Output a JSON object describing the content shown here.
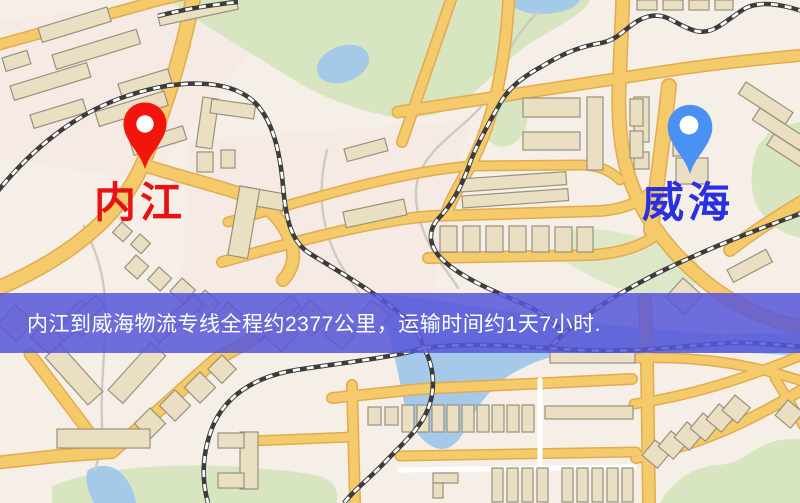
{
  "map": {
    "origin": {
      "label": "内江",
      "label_color": "#e81210",
      "pin_color": "#f2150b"
    },
    "destination": {
      "label": "威海",
      "label_color": "#2a2fdf",
      "pin_color": "#4b91f2"
    },
    "banner": {
      "text": "内江到威海物流专线全程约2377公里，运输时间约1天7小时.",
      "background": "rgba(86,86,217,0.85)",
      "text_color": "#ffffff"
    },
    "theme": {
      "land": "#f6efe7",
      "land_tint": "#f4e7e1",
      "park": "#d7e6c1",
      "water": "#a5c9e8",
      "road": "#f4ca6b",
      "road_casing": "#e2ab50",
      "minor_road": "#ffffff",
      "building": "#eadfc2",
      "building_outline": "#97917d",
      "railway_dark": "#3c3c3c",
      "railway_light": "#ffffff",
      "stream": "#cfcabd"
    }
  }
}
